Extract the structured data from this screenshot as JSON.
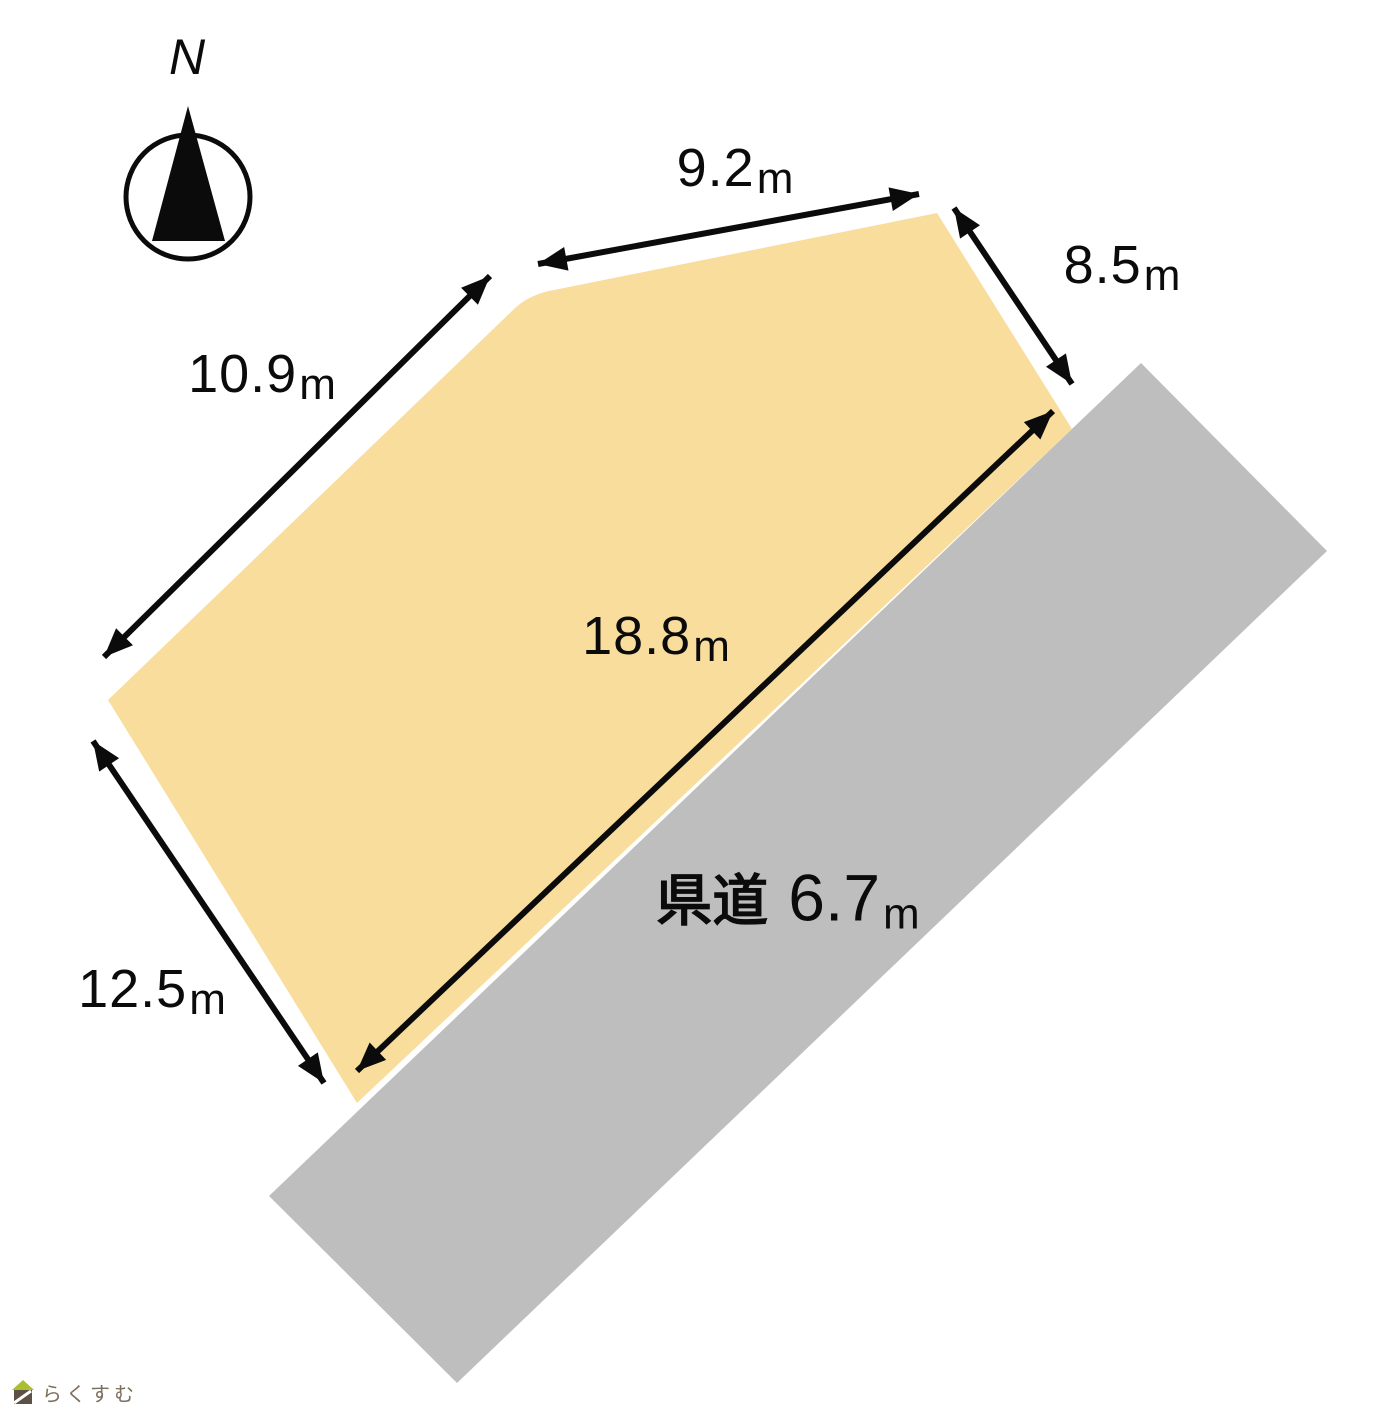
{
  "colors": {
    "plot_fill": "#F9DD9C",
    "road_fill": "#BEBEBE",
    "ink": "#0B0B0B"
  },
  "compass": {
    "north_label": "N"
  },
  "plot": {
    "dimensions": [
      {
        "side": "north",
        "value": "9.2",
        "unit": "m"
      },
      {
        "side": "northeast",
        "value": "8.5",
        "unit": "m"
      },
      {
        "side": "northwest",
        "value": "10.9",
        "unit": "m"
      },
      {
        "side": "road-frontage",
        "value": "18.8",
        "unit": "m"
      },
      {
        "side": "southwest",
        "value": "12.5",
        "unit": "m"
      }
    ]
  },
  "road": {
    "name": "県道",
    "width_value": "6.7",
    "width_unit": "m"
  },
  "watermark": {
    "brand": "らくすむ"
  }
}
